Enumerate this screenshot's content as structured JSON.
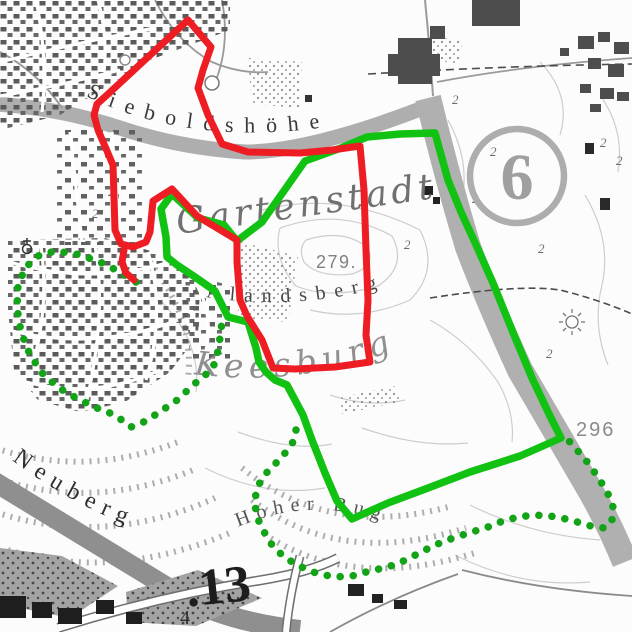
{
  "map": {
    "labels": {
      "sieboldshohe": "Sieboldshöhe",
      "gartenstadt": "Gartenstadt",
      "alandsberg": "Alandsberg",
      "keesburg": "Keesburg",
      "neuberg": "Neuberg",
      "hoher_bug": "Hoher Bug",
      "circle_number": "6",
      "spot_height_279": "279.",
      "spot_height_296": "296",
      "route_number_13": ".13",
      "number_4": "4"
    },
    "symbols": {
      "tree": "2",
      "church_icon": "church-circle-with-cross",
      "viewpoint_icon": "sunburst"
    },
    "colors": {
      "route_red": "#ee1c23",
      "route_green": "#12c212",
      "route_green_dotted": "#12a317",
      "road_fill": "#b3b3b3",
      "building_dark": "#4d4d4d",
      "building_black": "#1e1e1e",
      "contour": "#cdcdcd",
      "label_gray": "#707070"
    },
    "routes": {
      "red_loop": [
        [
          188,
          20
        ],
        [
          211,
          47
        ],
        [
          203,
          70
        ],
        [
          198,
          88
        ],
        [
          208,
          115
        ],
        [
          222,
          144
        ],
        [
          248,
          152
        ],
        [
          300,
          153
        ],
        [
          332,
          150
        ],
        [
          360,
          146
        ],
        [
          364,
          190
        ],
        [
          366,
          250
        ],
        [
          368,
          300
        ],
        [
          366,
          335
        ],
        [
          370,
          362
        ],
        [
          335,
          367
        ],
        [
          295,
          369
        ],
        [
          273,
          368
        ],
        [
          262,
          340
        ],
        [
          247,
          316
        ],
        [
          240,
          300
        ],
        [
          237,
          262
        ],
        [
          237,
          240
        ],
        [
          197,
          216
        ],
        [
          172,
          189
        ],
        [
          153,
          201
        ],
        [
          150,
          232
        ],
        [
          146,
          242
        ],
        [
          133,
          247
        ],
        [
          121,
          244
        ],
        [
          115,
          230
        ],
        [
          113,
          165
        ],
        [
          98,
          130
        ],
        [
          94,
          115
        ],
        [
          97,
          104
        ],
        [
          107,
          95
        ]
      ],
      "red_tail": [
        [
          124,
          250
        ],
        [
          122,
          262
        ],
        [
          126,
          273
        ],
        [
          134,
          280
        ]
      ],
      "green_loop": [
        [
          172,
          194
        ],
        [
          198,
          218
        ],
        [
          224,
          225
        ],
        [
          237,
          241
        ],
        [
          262,
          222
        ],
        [
          305,
          161
        ],
        [
          341,
          148
        ],
        [
          367,
          137
        ],
        [
          400,
          134
        ],
        [
          435,
          133
        ],
        [
          448,
          180
        ],
        [
          461,
          212
        ],
        [
          477,
          247
        ],
        [
          493,
          283
        ],
        [
          512,
          330
        ],
        [
          532,
          378
        ],
        [
          550,
          416
        ],
        [
          561,
          438
        ],
        [
          520,
          456
        ],
        [
          470,
          472
        ],
        [
          428,
          488
        ],
        [
          388,
          503
        ],
        [
          352,
          519
        ],
        [
          337,
          501
        ],
        [
          325,
          473
        ],
        [
          312,
          440
        ],
        [
          303,
          415
        ],
        [
          295,
          400
        ],
        [
          287,
          385
        ],
        [
          275,
          380
        ],
        [
          266,
          372
        ],
        [
          259,
          362
        ],
        [
          256,
          348
        ],
        [
          248,
          322
        ],
        [
          228,
          317
        ],
        [
          215,
          291
        ],
        [
          195,
          277
        ],
        [
          177,
          265
        ],
        [
          167,
          257
        ],
        [
          166,
          237
        ],
        [
          161,
          209
        ]
      ],
      "dotted_estate": [
        [
          136,
          282
        ],
        [
          118,
          271
        ],
        [
          98,
          261
        ],
        [
          76,
          254
        ],
        [
          55,
          251
        ],
        [
          38,
          256
        ],
        [
          25,
          268
        ],
        [
          18,
          286
        ],
        [
          17,
          308
        ],
        [
          21,
          332
        ],
        [
          30,
          355
        ],
        [
          43,
          374
        ],
        [
          59,
          388
        ],
        [
          78,
          399
        ],
        [
          97,
          408
        ],
        [
          115,
          415
        ],
        [
          131,
          427
        ],
        [
          146,
          421
        ],
        [
          161,
          411
        ],
        [
          176,
          401
        ],
        [
          189,
          389
        ],
        [
          201,
          378
        ],
        [
          212,
          370
        ],
        [
          217,
          356
        ],
        [
          220,
          338
        ],
        [
          222,
          322
        ],
        [
          224,
          315
        ]
      ],
      "dotted_hoherbug": [
        [
          296,
          430
        ],
        [
          293,
          442
        ],
        [
          286,
          452
        ],
        [
          277,
          462
        ],
        [
          268,
          471
        ],
        [
          261,
          480
        ],
        [
          256,
          492
        ],
        [
          255,
          505
        ],
        [
          257,
          517
        ],
        [
          263,
          530
        ],
        [
          272,
          545
        ],
        [
          284,
          557
        ],
        [
          299,
          566
        ],
        [
          316,
          573
        ],
        [
          334,
          577
        ],
        [
          352,
          576
        ],
        [
          370,
          571
        ],
        [
          388,
          567
        ],
        [
          406,
          560
        ],
        [
          423,
          551
        ],
        [
          440,
          543
        ],
        [
          456,
          537
        ],
        [
          472,
          532
        ],
        [
          488,
          527
        ],
        [
          503,
          521
        ],
        [
          518,
          517
        ],
        [
          534,
          515
        ],
        [
          550,
          516
        ],
        [
          566,
          519
        ],
        [
          581,
          523
        ],
        [
          594,
          527
        ],
        [
          605,
          528
        ],
        [
          612,
          520
        ],
        [
          613,
          507
        ],
        [
          608,
          494
        ],
        [
          601,
          482
        ],
        [
          593,
          470
        ],
        [
          585,
          459
        ],
        [
          576,
          449
        ],
        [
          569,
          441
        ]
      ]
    }
  }
}
